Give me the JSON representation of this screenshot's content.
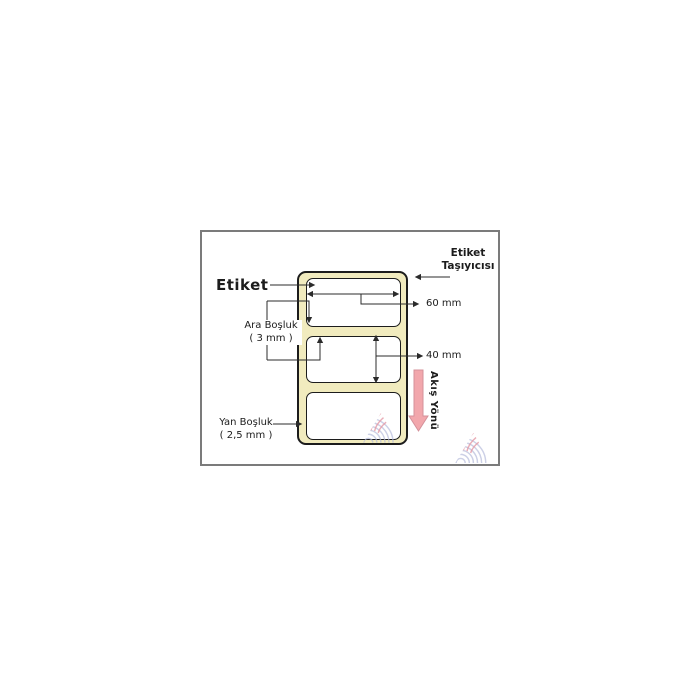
{
  "diagram": {
    "title_label": "Etiket",
    "carrier_label": {
      "line1": "Etiket",
      "line2": "Taşıyıcısı"
    },
    "width_dim": "60 mm",
    "height_dim": "40 mm",
    "gap_label": {
      "line1": "Ara Boşluk",
      "line2": "( 3 mm )"
    },
    "side_label": {
      "line1": "Yan Boşluk",
      "line2": "( 2,5 mm )"
    },
    "flow_label": "Akış Yönü",
    "label_count": 3
  },
  "icons": {
    "flow_arrow": "down-arrow",
    "watermark": "brand-watermark-triangle"
  },
  "colors": {
    "frame_border": "#7b7b7b",
    "carrier_fill": "#f1ebbe",
    "carrier_border": "#1c1c1c",
    "label_fill": "#ffffff",
    "label_border": "#1c1c1c",
    "line_color": "#2b2b2b",
    "flow_arrow_fill": "#f2a7ac",
    "flow_arrow_stroke": "#d4919a",
    "watermark_blue": "#b7bcdc",
    "watermark_pink": "#e59aa6"
  }
}
